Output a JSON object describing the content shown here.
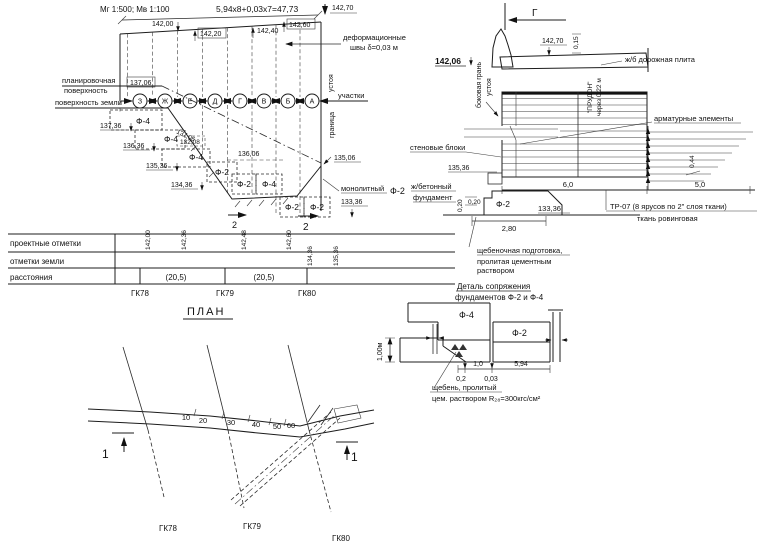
{
  "drawing": {
    "scales": "Мг 1:500; Мв 1:100",
    "elevation": {
      "top_dim": "5,94x8+0,03x7=47,73",
      "e14270": "142,70",
      "e14200": "142,00",
      "e14220": "142,20",
      "e14240": "142,40",
      "e14260": "142,60",
      "joints_l1": "деформационные",
      "joints_l2": "швы δ=0,03 м",
      "planning_l1": "планировочная",
      "planning_l2": "поверхность",
      "ground_label": "поверхность земли",
      "sections_label": "участки",
      "abutment_label": "устоя",
      "boundary_label": "граница",
      "e13706": "137,06",
      "e13706_slope": "137,06",
      "e13208": "132,08",
      "e13736": "137,36",
      "e13636": "136,36",
      "e13536": "135,36",
      "e13436": "134,36",
      "e13606": "136,06",
      "e13506": "135,06",
      "e13336": "133,36",
      "f4": "Ф-4",
      "f2": "Ф-2",
      "axes": [
        "З",
        "Ж",
        "Е",
        "Д",
        "Г",
        "В",
        "Б",
        "А"
      ],
      "mono_1": "монолитный",
      "mono_f2": "Ф-2",
      "mono_2": "ж/бетонный",
      "mono_3": "фундамент",
      "cut2": "2"
    },
    "table": {
      "row_design": "проектные отметки",
      "row_ground": "отметки земли",
      "row_dist": "расстояния",
      "design_values": [
        "142,00",
        "142,36",
        "142,48",
        "142,60"
      ],
      "ground_values": [
        "134,36",
        "135,36"
      ],
      "dist_1": "(20,5)",
      "dist_2": "(20,5)",
      "stations": [
        "ГК78",
        "ГК79",
        "ГК80"
      ]
    },
    "section": {
      "cut_label": "Г",
      "e14270": "142,70",
      "d015": "0,15",
      "road_slab": "ж/б дорожная плита",
      "e14206": "142,06",
      "side_face_l1": "боковая грань",
      "side_face_l2": "устоя",
      "prudon_l1": "\"ПРУДОН\"",
      "prudon_l2": "через 0,22 м",
      "rebar_label": "арматурные элементы",
      "wall_blocks": "стеновые блоки",
      "e13536": "135,36",
      "d044": "0,44",
      "d60": "6,0",
      "d50": "5,0",
      "f2": "Ф-2",
      "d020v": "0,20",
      "d020h": "0,20",
      "e13336": "133,36",
      "d280": "2,80",
      "tr07": "ТР-07 (8 ярусов по 2\" слоя ткани)",
      "roving": "ткань ровинговая",
      "rubble_l1": "щебеночная подготовка,",
      "rubble_l2": "пролитая цементным",
      "rubble_l3": "раствором"
    },
    "detail": {
      "title_l1": "Деталь сопряжения",
      "title_l2": "фундаментов Ф-2 и Ф-4",
      "f4": "Ф-4",
      "f2": "Ф-2",
      "h100": "1,00м",
      "d10": "1,0",
      "d594": "5,94",
      "d02": "0,2",
      "d003": "0,03",
      "note_l1": "щебень, пролитый",
      "note_l2": "цем. раствором R₂₈=300кгс/см²"
    },
    "plan": {
      "title": "ПЛАН",
      "chainage": [
        "10",
        "20",
        "30",
        "40",
        "50",
        "60"
      ],
      "stations": [
        "ГК78",
        "ГК79",
        "ГК80"
      ],
      "cut1": "1"
    }
  }
}
